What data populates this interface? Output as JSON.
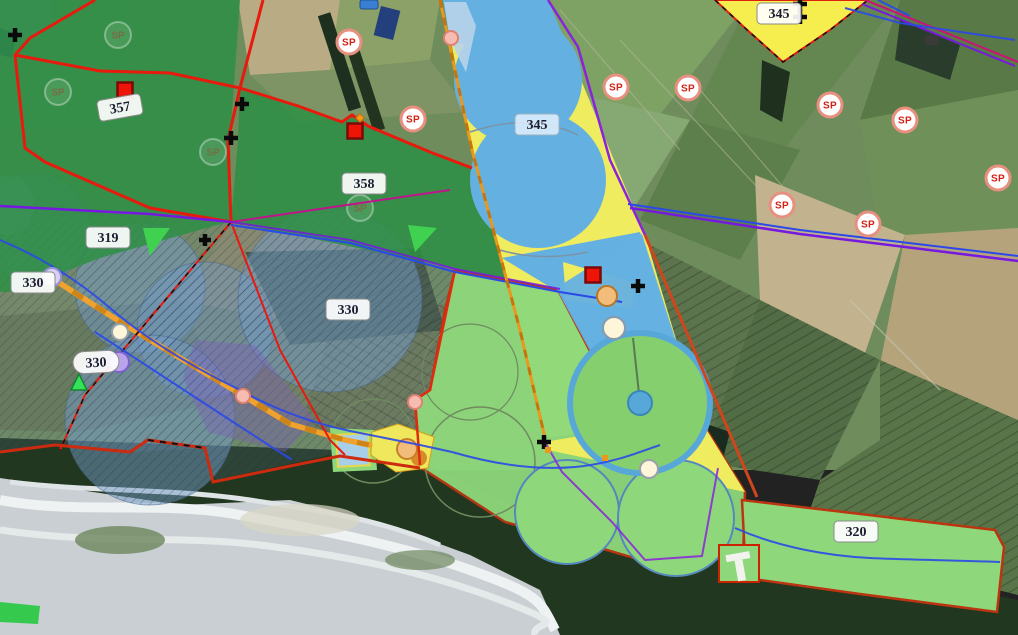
{
  "labels": {
    "p357": "357",
    "p358": "358",
    "p345_band": "345",
    "p345_ne": "345",
    "p319": "319",
    "p330_left": "330",
    "p330_mid": "330",
    "p330_road": "330",
    "p320": "320"
  },
  "badges": {
    "sp": "SP"
  },
  "colors": {
    "parcel_dark_green": "#2f8f46",
    "parcel_light_green": "#8ed87b",
    "parcel_yellow": "#f0ec5f",
    "parcel_blue": "#64b1e1",
    "pivot_ring_blue": "#57a7d9",
    "boundary_red": "#e81a0e",
    "boundary_brown_red": "#bb3511",
    "boundary_purple": "#7718e0",
    "boundary_magenta": "#cc1177",
    "stream_blue": "#2b49e8",
    "road_orange": "#efa22e",
    "sp_text_red": "#d42015",
    "marker_red_square": "#ee1408",
    "marker_pink": "#f6bcb2",
    "marker_cream": "#fdf6da",
    "marker_tan": "#f2bd7a",
    "marker_lavender": "#d8d2f2",
    "marker_green_triangle": "#35e35b"
  }
}
